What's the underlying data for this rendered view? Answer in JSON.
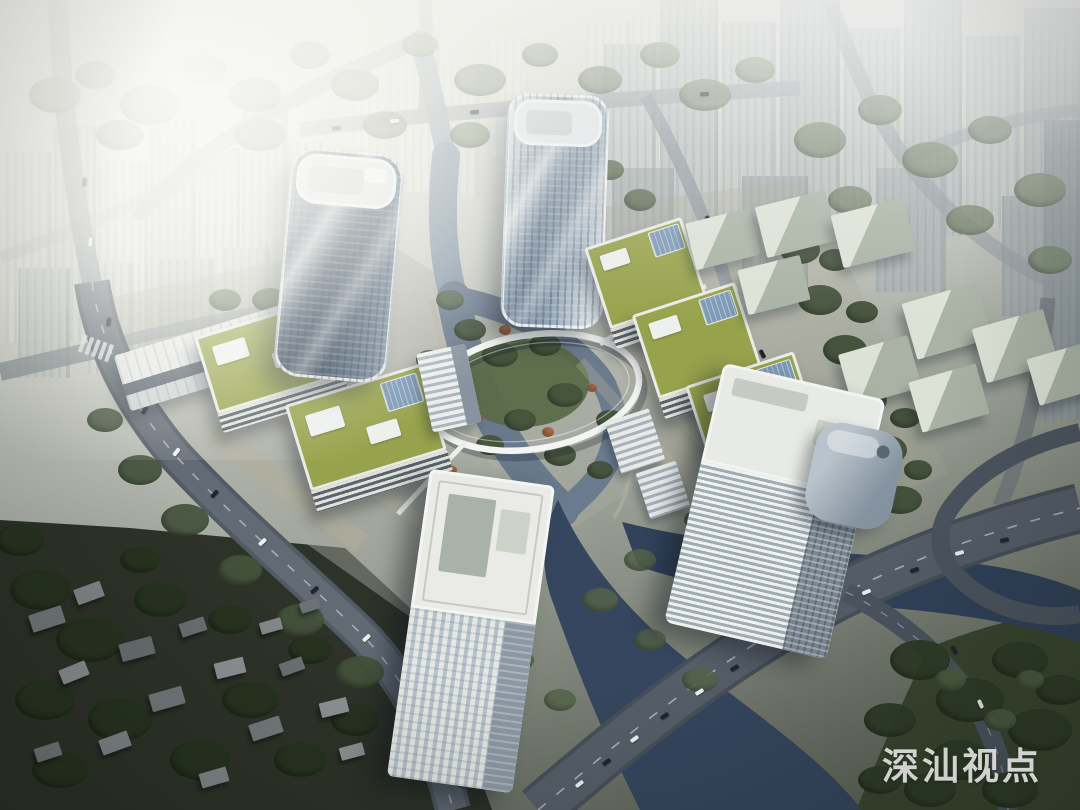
{
  "watermark": {
    "text": "深汕视点"
  },
  "scene": {
    "description": "Aerial architectural rendering: twin glass towers and green-roof office blocks beside a forked river crossed by a circular pedestrian ring bridge, with a highway bridge, interchange, village, parks and a hazy high-rise skyline behind",
    "palette": {
      "haze": "#f0f0ea",
      "glass_tower_dark": "#2f4055",
      "glass_tower_light": "#8fa2b2",
      "green_roof": "#97a24c",
      "water_light": "#8495a5",
      "water_dark": "#35465e",
      "road": "#565e69",
      "park_green": "#39462f",
      "warehouse": "#ccd4c8",
      "village_ground": "#2e3329"
    }
  }
}
